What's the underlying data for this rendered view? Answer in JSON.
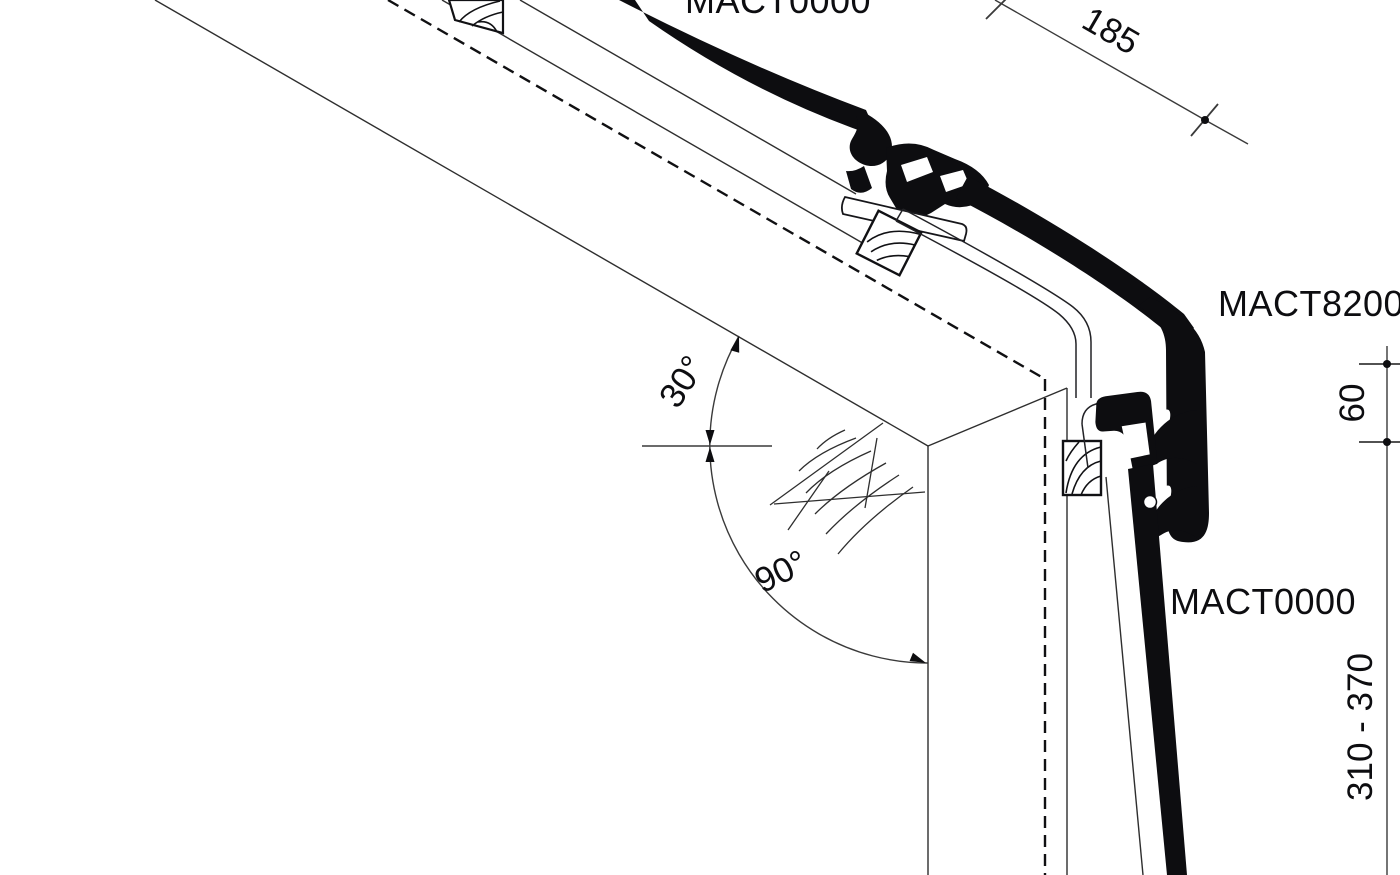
{
  "drawing": {
    "type": "technical-section-detail",
    "labels": {
      "label_top": "MACT0000",
      "label_corner": "MACT8200",
      "label_side": "MACT0000"
    },
    "dimensions": {
      "dim_185": "185",
      "dim_60": "60",
      "dim_310_370": "310 - 370"
    },
    "angles": {
      "angle_30": "30°",
      "angle_90": "90°"
    },
    "colors": {
      "ink": "#0d0d10",
      "thin_line": "#2e2e2e",
      "dim_line": "#3a3a3a",
      "background": "#ffffff"
    }
  }
}
